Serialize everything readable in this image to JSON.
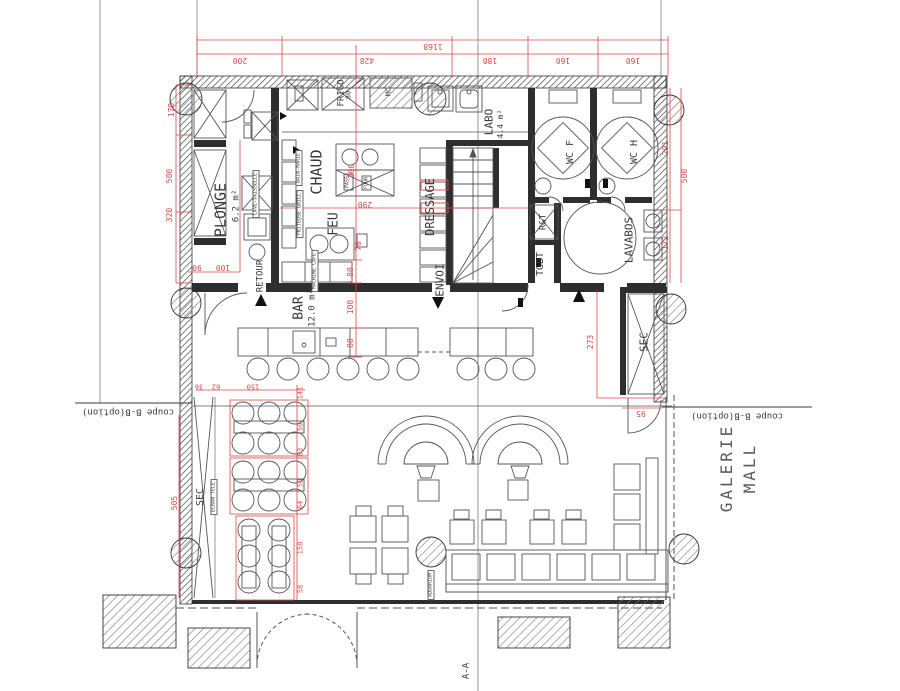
{
  "labels": {
    "plonge": "PLONGE",
    "plonge_area": "6.2 m²",
    "chaud": "CHAUD",
    "feu": "FEU",
    "dressage": "DRESSAGE",
    "envoi": "ENVOI",
    "bar": "BAR",
    "bar_area": "12.0 m²",
    "labo": "LABO",
    "labo_area": "4.4 m²",
    "wc_f": "WC F",
    "wc_h": "WC H",
    "lavabos": "LAVABOS",
    "rt": "R&T",
    "tgbt": "TGBT",
    "sec_right": "SEC",
    "sec_left": "SEC",
    "retour": "RETOUR",
    "galerie": "GALERIE",
    "mall": "MALL"
  },
  "equipment": {
    "frigo": "FRIGO",
    "mc": "MC",
    "bain_marie": "BAIN-MARIE",
    "friteuse_grill": "FRITEUSE GRILL",
    "lave_vaisselle": "LAVE-VAISSELLE",
    "machine_cafe": "MACHINE CAFE",
    "ecran_tele": "ECRAN TELE",
    "aquarium": "AQUARIUM",
    "pass": "PASS",
    "four": "FOUR"
  },
  "sections": {
    "coupe": "coupe B-B(option)",
    "aa": "A-A"
  },
  "dims": {
    "d1168": "1168",
    "d200": "200",
    "d428": "428",
    "d180": "180",
    "d160a": "160",
    "d160b": "160",
    "d170": "170",
    "d500l": "500",
    "d320": "320",
    "d505": "505",
    "d291": "291",
    "d500r": "500",
    "d172": "172",
    "d273": "273",
    "d95": "95",
    "d300": "300",
    "d290": "290",
    "d70": "70",
    "d80f": "80",
    "d90": "90",
    "d100": "100",
    "d80a": "80",
    "d100b": "100",
    "d80b": "80",
    "d36": "36",
    "d62": "62",
    "d150a": "150",
    "d141": "141",
    "d50a": "50",
    "d83": "83",
    "d50b": "50",
    "d64": "64",
    "d150b": "150",
    "d58": "58"
  },
  "colors": {
    "dim_red": "#d84a4a",
    "wall": "#2e2e2e",
    "line": "#555555",
    "grid": "#8a8a8a"
  }
}
